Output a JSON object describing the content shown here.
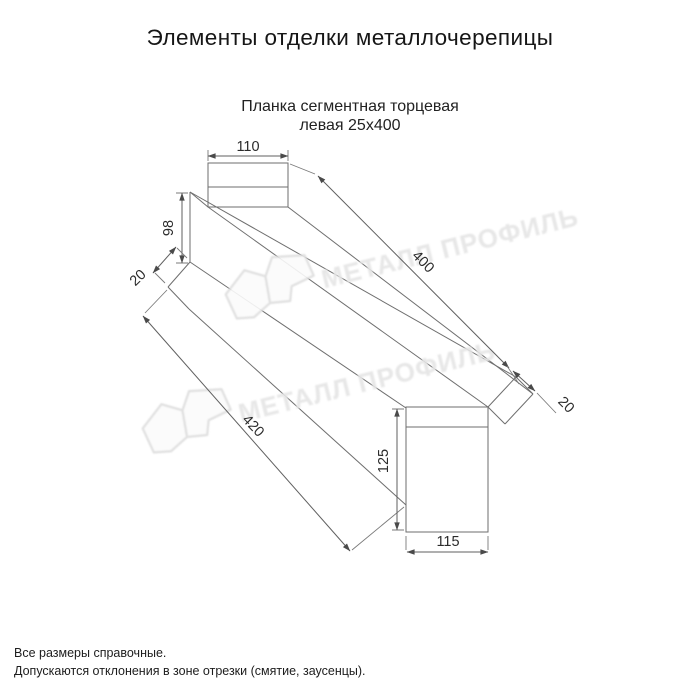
{
  "header": {
    "title": "Элементы отделки металлочерепицы"
  },
  "product": {
    "name_line1": "Планка сегментная торцевая",
    "name_line2": "левая 25х400"
  },
  "watermark": {
    "text": "МЕТАЛЛ ПРОФИЛЬ",
    "color": "#e5e5e5"
  },
  "dimensions": {
    "top_cap_width": "110",
    "left_end_height": "98",
    "left_hem": "20",
    "top_edge_length": "400",
    "bottom_edge_length": "420",
    "right_hem": "20",
    "right_end_height": "125",
    "bottom_cap_width": "115"
  },
  "footnotes": {
    "line1": "Все размеры справочные.",
    "line2": "Допускаются отклонения в зоне отрезки (смятие, заусенцы)."
  }
}
